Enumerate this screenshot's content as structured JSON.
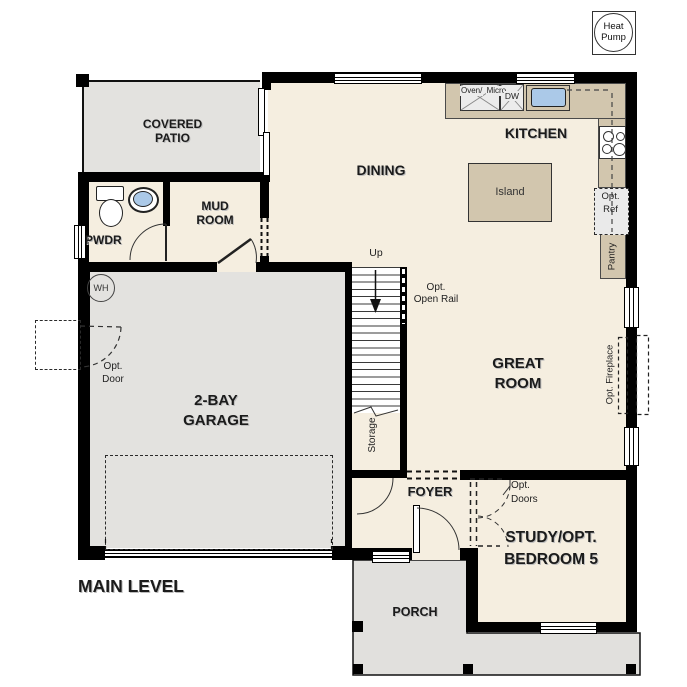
{
  "title": "MAIN LEVEL",
  "colors": {
    "floor": "#f5eee0",
    "outdoor_concrete": "#e3e2df",
    "counter_tan": "#d2c6ae",
    "sink_blue": "#abc9e8",
    "wall": "#000000"
  },
  "rooms": {
    "covered_patio": {
      "line1": "COVERED",
      "line2": "PATIO"
    },
    "pwdr": {
      "label": "PWDR"
    },
    "mud_room": {
      "line1": "MUD",
      "line2": "ROOM"
    },
    "dining": {
      "label": "DINING"
    },
    "kitchen": {
      "label": "KITCHEN"
    },
    "great_room": {
      "line1": "GREAT",
      "line2": "ROOM"
    },
    "garage": {
      "line1": "2-BAY",
      "line2": "GARAGE"
    },
    "foyer": {
      "label": "FOYER"
    },
    "study": {
      "line1": "STUDY/OPT.",
      "line2": "BEDROOM 5"
    },
    "porch": {
      "label": "PORCH"
    },
    "storage": {
      "label": "Storage"
    }
  },
  "stairs": {
    "up": "Up",
    "open_rail_line1": "Opt.",
    "open_rail_line2": "Open Rail"
  },
  "fixtures": {
    "heat_pump": {
      "line1": "Heat",
      "line2": "Pump"
    },
    "oven_micro": {
      "line1": "Oven/",
      "line2": "Micro"
    },
    "dishwasher": "DW",
    "island": "Island",
    "opt_ref": {
      "line1": "Opt.",
      "line2": "Ref"
    },
    "pantry": "Pantry",
    "opt_fireplace": "Opt. Fireplace",
    "opt_door": {
      "line1": "Opt.",
      "line2": "Door"
    },
    "opt_doors": {
      "line1": "Opt.",
      "line2": "Doors"
    },
    "water_heater": "WH"
  },
  "plan_title": "MAIN LEVEL"
}
